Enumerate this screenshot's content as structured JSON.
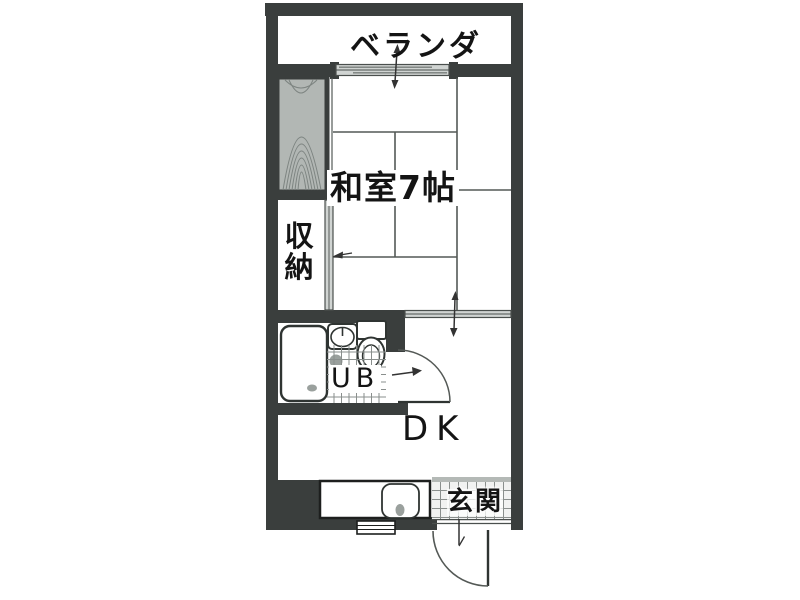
{
  "plan": {
    "rooms": {
      "veranda": "ベランダ",
      "japanese_room": "和室7帖",
      "storage": "収納",
      "unit_bath": "UB",
      "dining_kitchen": "DK",
      "entrance": "玄関"
    },
    "fixtures": [
      "bathtub",
      "washbasin",
      "toilet",
      "kitchen-sink",
      "tatami-mats",
      "wood-floor-panel",
      "sliding-door",
      "swing-door",
      "direction-arrow"
    ],
    "colors": {
      "wall": "#3a3e3d",
      "background": "#ffffff",
      "door_gray": "#d0d4d2",
      "wood_panel": "#b2b7b4",
      "wood_grain": "#7d8481",
      "tile_line": "#8a8f8d",
      "fixture_gray": "#9aa09d",
      "line": "#545956",
      "text": "#141414"
    }
  }
}
